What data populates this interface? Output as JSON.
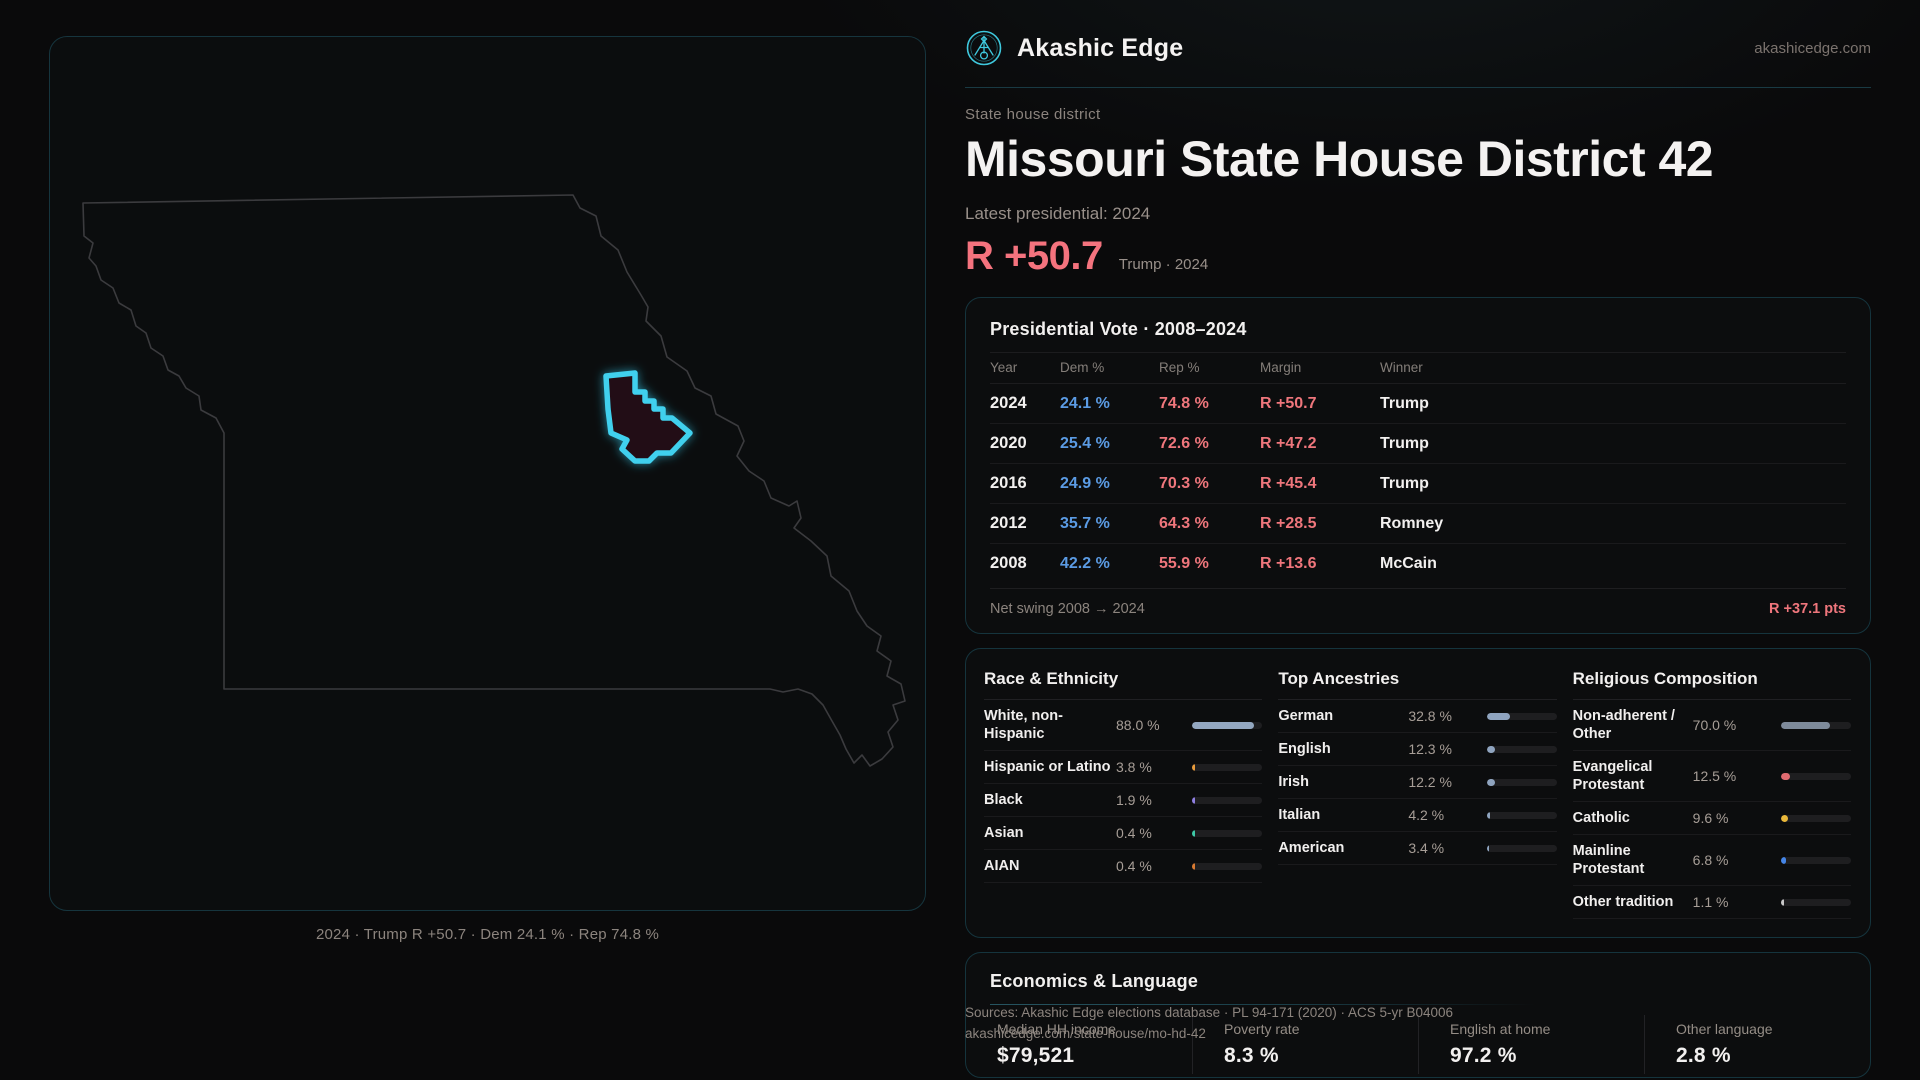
{
  "brand": {
    "name": "Akashic Edge",
    "domain": "akashicedge.com"
  },
  "header": {
    "eyebrow": "State house district",
    "title": "Missouri State House District 42",
    "latest_label": "Latest presidential: 2024",
    "margin_value": "R +50.7",
    "margin_context": "Trump · 2024"
  },
  "map": {
    "caption": "2024 · Trump R +50.7 · Dem 24.1 % · Rep 74.8 %"
  },
  "vote_table": {
    "title": "Presidential Vote · 2008–2024",
    "columns": {
      "year": "Year",
      "dem": "Dem %",
      "rep": "Rep %",
      "margin": "Margin",
      "winner": "Winner"
    },
    "rows": [
      {
        "year": "2024",
        "dem": "24.1 %",
        "rep": "74.8 %",
        "margin": "R +50.7",
        "winner": "Trump"
      },
      {
        "year": "2020",
        "dem": "25.4 %",
        "rep": "72.6 %",
        "margin": "R +47.2",
        "winner": "Trump"
      },
      {
        "year": "2016",
        "dem": "24.9 %",
        "rep": "70.3 %",
        "margin": "R +45.4",
        "winner": "Trump"
      },
      {
        "year": "2012",
        "dem": "35.7 %",
        "rep": "64.3 %",
        "margin": "R +28.5",
        "winner": "Romney"
      },
      {
        "year": "2008",
        "dem": "42.2 %",
        "rep": "55.9 %",
        "margin": "R +13.6",
        "winner": "McCain"
      }
    ],
    "net_swing_label": "Net swing 2008 → 2024",
    "net_swing_value": "R +37.1 pts"
  },
  "demographics": {
    "race": {
      "title": "Race & Ethnicity",
      "rows": [
        {
          "label": "White, non-Hispanic",
          "value": "88.0 %",
          "pct": 88.0,
          "color": "#93a7c0"
        },
        {
          "label": "Hispanic or Latino",
          "value": "3.8 %",
          "pct": 3.8,
          "color": "#e89b3c"
        },
        {
          "label": "Black",
          "value": "1.9 %",
          "pct": 1.9,
          "color": "#8f7fe0"
        },
        {
          "label": "Asian",
          "value": "0.4 %",
          "pct": 0.4,
          "color": "#3ec9a7"
        },
        {
          "label": "AIAN",
          "value": "0.4 %",
          "pct": 0.4,
          "color": "#d97a32"
        }
      ]
    },
    "ancestries": {
      "title": "Top Ancestries",
      "rows": [
        {
          "label": "German",
          "value": "32.8 %",
          "pct": 32.8,
          "color": "#8fa4bf"
        },
        {
          "label": "English",
          "value": "12.3 %",
          "pct": 12.3,
          "color": "#8fa4bf"
        },
        {
          "label": "Irish",
          "value": "12.2 %",
          "pct": 12.2,
          "color": "#8fa4bf"
        },
        {
          "label": "Italian",
          "value": "4.2 %",
          "pct": 4.2,
          "color": "#8fa4bf"
        },
        {
          "label": "American",
          "value": "3.4 %",
          "pct": 3.4,
          "color": "#8fa4bf"
        }
      ]
    },
    "religion": {
      "title": "Religious Composition",
      "rows": [
        {
          "label": "Non-adherent / Other",
          "value": "70.0 %",
          "pct": 70.0,
          "color": "#7e8a9a"
        },
        {
          "label": "Evangelical Protestant",
          "value": "12.5 %",
          "pct": 12.5,
          "color": "#e06b70"
        },
        {
          "label": "Catholic",
          "value": "9.6 %",
          "pct": 9.6,
          "color": "#e9b83a"
        },
        {
          "label": "Mainline Protestant",
          "value": "6.8 %",
          "pct": 6.8,
          "color": "#4585e6"
        },
        {
          "label": "Other tradition",
          "value": "1.1 %",
          "pct": 1.1,
          "color": "#c9c9c9"
        }
      ]
    }
  },
  "economics": {
    "title": "Economics & Language",
    "stats": [
      {
        "label": "Median HH income",
        "value": "$79,521"
      },
      {
        "label": "Poverty rate",
        "value": "8.3 %"
      },
      {
        "label": "English at home",
        "value": "97.2 %"
      },
      {
        "label": "Other language",
        "value": "2.8 %"
      }
    ]
  },
  "footer": {
    "line1": "Sources: Akashic Edge elections database · PL 94-171 (2020) · ACS 5-yr B04006",
    "line2": "akashicedge.com/state-house/mo-hd-42"
  },
  "colors": {
    "accent_cyan": "#41d0ee",
    "dem_blue": "#5b9be4",
    "rep_red": "#ef767c",
    "margin_red": "#f4737e",
    "panel_border": "#15343d"
  }
}
